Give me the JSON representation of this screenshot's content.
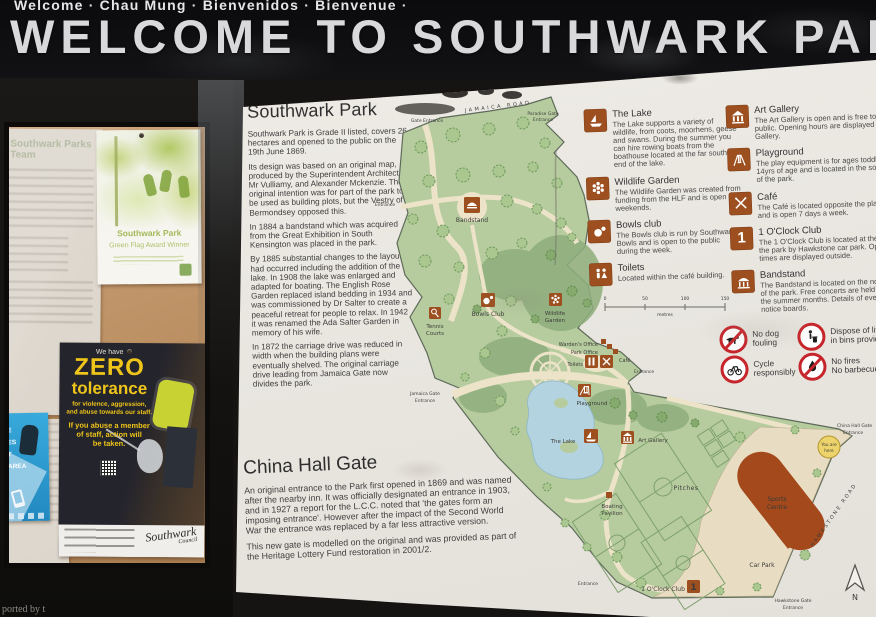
{
  "banner": {
    "languages": "Welcome · Chau Mung · Bienvenidos · Bienvenue ·",
    "title": "WELCOME TO SOUTHWARK PARK"
  },
  "notice_board": {
    "team_poster_title": "Southwark Parks Team",
    "green_flag": {
      "line1": "Southwark Park",
      "line2": "Green Flag Award Winner"
    },
    "zero_poster": {
      "intro": "We have",
      "word1": "ZERO",
      "word2": "tolerance",
      "sub1": "for violence, aggression,",
      "sub2": "and abuse towards our staff.",
      "body1": "If you abuse a member",
      "body2": "of staff, action will",
      "body3": "be taken.",
      "logo1": "Southwark",
      "logo2": "Council"
    },
    "blue_poster": {
      "frag1": "E",
      "frag2": "ES",
      "frag3": "T",
      "frag4": "AREA"
    }
  },
  "photo_caption": "ported by t",
  "sign": {
    "history": {
      "title": "Southwark Park",
      "p1": "Southwark Park is Grade II listed, covers 26 hectares and opened to the public on the 19th June 1869.",
      "p2": "Its design was based on an original map, produced by the Superintendent Architect, Mr Vulliamy, and Alexander Mckenzie. The original intention was for part of the park to be used as building plots, but the Vestry of Bermondsey opposed this.",
      "p3": "In 1884 a bandstand which was acquired from the Great Exhibition in South Kensington was placed in the park.",
      "p4": "By 1885 substantial changes to the layout had occurred including the addition of the lake. In 1908 the lake was enlarged and adapted for boating. The English Rose Garden replaced island bedding in 1934 and was commissioned by Dr Salter to create a peaceful retreat for people to relax. In 1942 it was renamed the Ada Salter Garden in memory of his wife.",
      "p5": "In 1872 the carriage drive was reduced in width when the building plans were eventually shelved. The original carriage drive leading from Jamaica Gate now divides the park."
    },
    "china_hall": {
      "title": "China Hall Gate",
      "p1": "An original entrance to the Park first opened in 1869 and was named after the nearby inn. It was officially designated an entrance in 1903, and in 1927 a report for the L.C.C. noted that 'the gates form an imposing entrance'. However after the impact of the Second World War the entrance was replaced by a far less attractive version.",
      "p2": "This new gate is modelled on the original and was provided as part of the Heritage Lottery Fund restoration in 2001/2."
    },
    "legend": [
      {
        "name": "The Lake",
        "icon": "sailboat",
        "desc": "The Lake supports a variety of wildlife, from coots, moorhens, geese and swans. During the summer you can hire rowing boats from the boathouse located at the far southern end of the lake."
      },
      {
        "name": "Wildlife Garden",
        "icon": "flower",
        "desc": "The Wildlife Garden was created from funding from the HLF and is open at weekends."
      },
      {
        "name": "Bowls club",
        "icon": "bowls",
        "desc": "The Bowls club is run by Southwark Bowls and is open to the public during the week."
      },
      {
        "name": "Toilets",
        "icon": "toilets",
        "desc": "Located within the café building."
      },
      {
        "name": "Art Gallery",
        "icon": "museum",
        "desc": "The Art Gallery is open and is free to the public. Opening hours are displayed at the Gallery."
      },
      {
        "name": "Playground",
        "icon": "swing",
        "desc": "The play equipment is for ages toddler to 14yrs of age and is located in the south end of the park."
      },
      {
        "name": "Café",
        "icon": "cutlery",
        "desc": "The Café is located opposite the playground and is open 7 days a week."
      },
      {
        "name": "1 O'Clock Club",
        "icon": "number-one",
        "desc": "The 1 O'Clock Club is located at the end of the park by Hawkstone car park. Opening times are displayed outside."
      },
      {
        "name": "Bandstand",
        "icon": "bandstand",
        "desc": "The Bandstand is located on the north side of the park. Free concerts are held during the summer months. Details of events are in notice boards."
      }
    ],
    "rules": [
      {
        "line1": "No dog",
        "line2": "fouling"
      },
      {
        "line1": "Dispose of litter",
        "line2": "in bins provided"
      },
      {
        "line1": "Cycle",
        "line2": "responsibly"
      },
      {
        "line1": "No fires",
        "line2": "No barbecues"
      }
    ],
    "map": {
      "labels": {
        "road_top": "JAMAICA ROAD",
        "gate_nw": "Gate Entrance",
        "paradise1": "Paradise Gate",
        "paradise2": "Entrance",
        "entrance_w": "Entrance",
        "bandstand": "Bandstand",
        "tennis1": "Tennis",
        "tennis2": "Courts",
        "bowls": "Bowls Club",
        "wildlife1": "Wildlife",
        "wildlife2": "Garden",
        "wardens": "Warden's Office",
        "park_office": "Park Office",
        "toilets": "Toilets",
        "cafe": "Café",
        "entrance_cafe": "Entrance",
        "jamaica1": "Jamaica Gate",
        "jamaica2": "Entrance",
        "playground": "Playground",
        "lake": "The Lake",
        "art": "Art Gallery",
        "boating1": "Boating",
        "boating2": "Pavilion",
        "pitches": "Pitches",
        "sports1": "Sports",
        "sports2": "Centre",
        "car_park": "Car Park",
        "oclock": "1 O'Clock Club",
        "entrance_s": "Entrance",
        "hawk_road": "HAWKSTONE ROAD",
        "hawk1": "Hawkstone Gate",
        "hawk2": "Entrance",
        "china1": "China Hall Gate",
        "china2": "Entrance",
        "you1": "You are",
        "you2": "here",
        "north": "N",
        "one_glyph": "1"
      },
      "scale": {
        "t0": "0",
        "t1": "50",
        "t2": "100",
        "t3": "150",
        "unit": "metres"
      }
    }
  }
}
